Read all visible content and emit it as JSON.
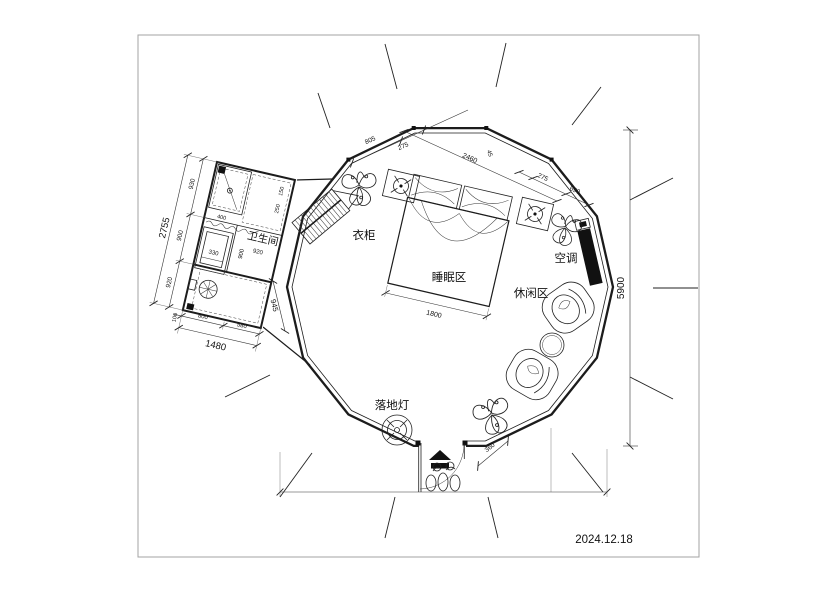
{
  "page": {
    "date": "2024.12.18"
  },
  "plan": {
    "labels": {
      "bathroom": "卫生间",
      "wardrobe": "衣柜",
      "sleeping_area": "睡眠区",
      "leisure_area": "休闲区",
      "air_conditioner": "空调",
      "floor_lamp": "落地灯"
    },
    "dimensions": {
      "overall_height": "5900",
      "bed_width": "1800",
      "door_side_offset": "360",
      "bathroom_side_total": "2755",
      "bathroom_side_chain": [
        "930",
        "900",
        "920"
      ],
      "bathroom_bottom_total": "1480",
      "bathroom_bottom_chain": [
        "800",
        "580"
      ],
      "bathroom_bottom_start": "100",
      "bathroom_to_door": "945",
      "top_left_chain": [
        "805",
        "275"
      ],
      "top_span": "2460",
      "top_span_minor": "45",
      "top_right_chain": [
        "275",
        "690"
      ],
      "bathroom_inner": {
        "shower_width": "400",
        "shelf_a": "150",
        "shelf_b": "250",
        "sink_width": "330",
        "room_width_a": "900",
        "room_width_b": "920"
      }
    },
    "colors": {
      "line": "#1c1c1c",
      "dim": "#333333",
      "frame": "#a3a3a3",
      "solid_fill": "#111111"
    }
  }
}
